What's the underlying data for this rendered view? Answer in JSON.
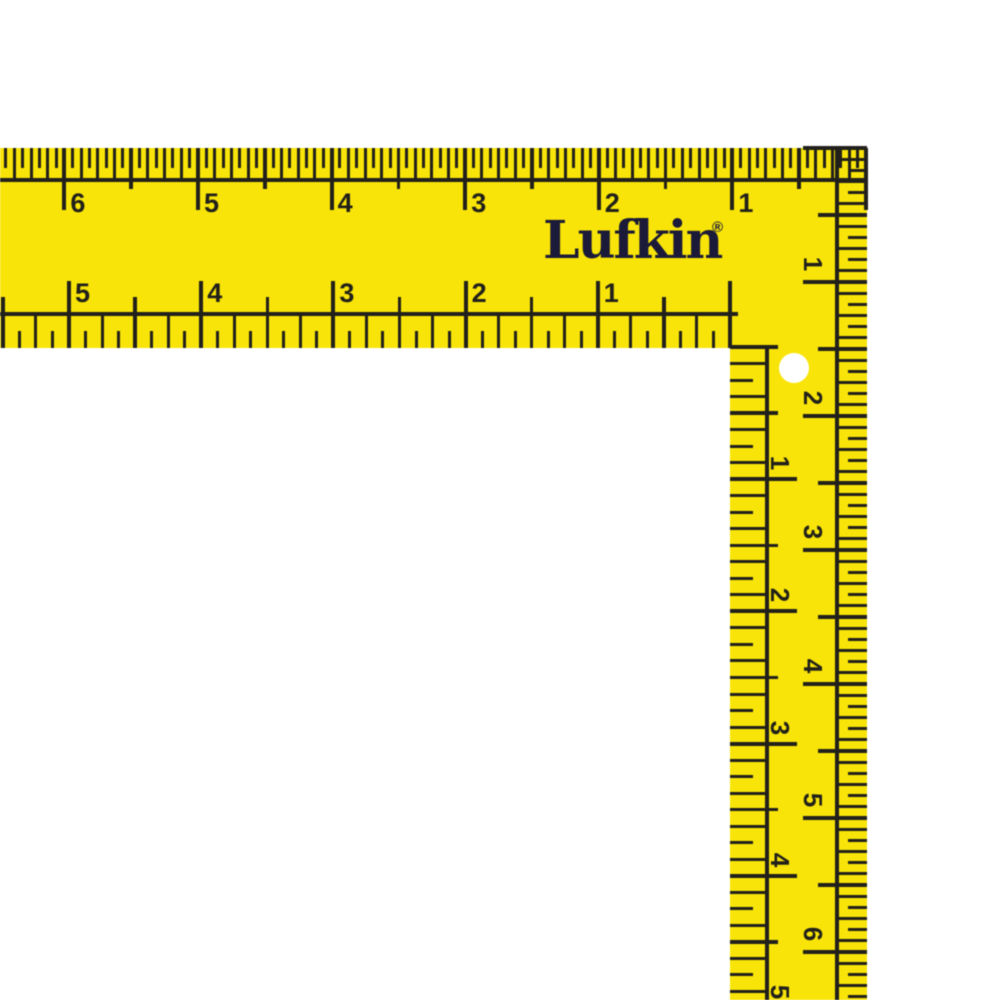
{
  "object": {
    "description": "Yellow L-shaped carpenter framing square (rafter square) with black inch markings, shown cropped at left and bottom edges on a white background"
  },
  "brand": {
    "name": "Lufkin",
    "registered": "®"
  },
  "colors": {
    "body_yellow": "#f8e408",
    "marking_ink": "#21201a",
    "logo_navy": "#1b1a38",
    "hole_white": "#ffffff",
    "background": "#ffffff"
  },
  "scales": {
    "top_outer": {
      "edge": "top edge of horizontal blade, zero at outer corner, reads right to left",
      "numbers": [
        "6",
        "5",
        "4",
        "3",
        "2",
        "1"
      ],
      "divisions_per_inch": 16
    },
    "bottom_inner": {
      "edge": "bottom edge of horizontal blade, zero at inner corner, reads right to left",
      "numbers": [
        "5",
        "4",
        "3",
        "2",
        "1"
      ],
      "divisions_per_inch": 8
    },
    "right_outer": {
      "edge": "outer (right) edge of vertical tongue, zero at top, reads downward, digits rotated 90deg",
      "numbers": [
        "1",
        "2",
        "3",
        "4",
        "5",
        "6"
      ],
      "divisions_per_inch": 12
    },
    "right_inner": {
      "edge": "inner (left) edge of vertical tongue, zero at inner corner, reads downward, digits rotated 90deg",
      "numbers": [
        "1",
        "2",
        "3",
        "4",
        "5"
      ],
      "divisions_per_inch": 8
    }
  }
}
